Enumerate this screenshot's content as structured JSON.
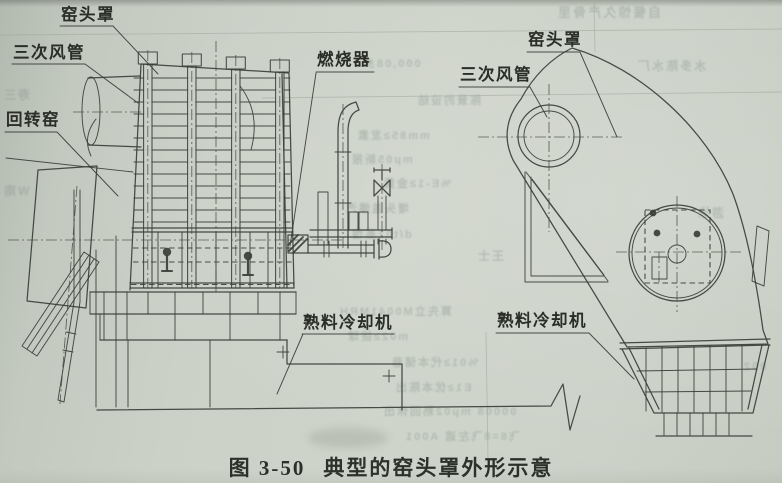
{
  "figure": {
    "caption_number": "图 3-50",
    "caption_title": "典型的窑头罩外形示意"
  },
  "labels": {
    "left": [
      {
        "id": "kiln-hood",
        "text": "窑头罩"
      },
      {
        "id": "tertiary-air-duct",
        "text": "三次风管"
      },
      {
        "id": "rotary-kiln",
        "text": "回转窑"
      },
      {
        "id": "burner",
        "text": "燃烧器"
      },
      {
        "id": "clinker-cooler",
        "text": "熟料冷却机"
      }
    ],
    "right": [
      {
        "id": "kiln-hood",
        "text": "窑头罩"
      },
      {
        "id": "tertiary-air-duct",
        "text": "三次风管"
      },
      {
        "id": "clinker-cooler",
        "text": "熟料冷却机"
      }
    ]
  },
  "colors": {
    "paper": "#cbd1c8",
    "ink": "#3a3e37",
    "bleedthrough": "#87948a"
  },
  "bleedthrough_noise": [
    {
      "x": 556,
      "y": 2,
      "s": 13,
      "t": "自餐惊久产骨里"
    },
    {
      "x": 636,
      "y": 57,
      "s": 12,
      "t": "水多陈水厂"
    },
    {
      "x": 362,
      "y": 55,
      "s": 11,
      "t": "000,08乡"
    },
    {
      "x": 416,
      "y": 92,
      "s": 11,
      "t": "陈景的设结"
    },
    {
      "x": 356,
      "y": 127,
      "s": 11,
      "t": "mm85≥发素"
    },
    {
      "x": 350,
      "y": 151,
      "s": 11,
      "t": "mμ05新报"
    },
    {
      "x": 382,
      "y": 175,
      "s": 11,
      "t": "%E-1≥金黄"
    },
    {
      "x": 344,
      "y": 200,
      "s": 11,
      "t": "增头盖爆汽"
    },
    {
      "x": 350,
      "y": 226,
      "s": 11,
      "t": "d/t01蒸馏"
    },
    {
      "x": 338,
      "y": 303,
      "s": 11,
      "t": "算先立M0041MRH"
    },
    {
      "x": 346,
      "y": 328,
      "s": 11,
      "t": "m02≥拨球"
    },
    {
      "x": 390,
      "y": 354,
      "s": 11,
      "t": "%01≥代本储巷"
    },
    {
      "x": 394,
      "y": 379,
      "s": 11,
      "t": "E1≥优本陈出"
    },
    {
      "x": 382,
      "y": 403,
      "s": 11,
      "t": "00008 mμ02熟回休出"
    },
    {
      "x": 404,
      "y": 428,
      "s": 11,
      "t": "飞8=8飞左遮 A001"
    },
    {
      "x": 696,
      "y": 204,
      "s": 12,
      "t": "游泳"
    },
    {
      "x": 742,
      "y": 361,
      "s": 11,
      "t": "002"
    },
    {
      "x": 2,
      "y": 86,
      "s": 12,
      "t": "寿三"
    },
    {
      "x": 2,
      "y": 182,
      "s": 12,
      "t": "W南"
    },
    {
      "x": 476,
      "y": 247,
      "s": 12,
      "t": "王士"
    }
  ]
}
